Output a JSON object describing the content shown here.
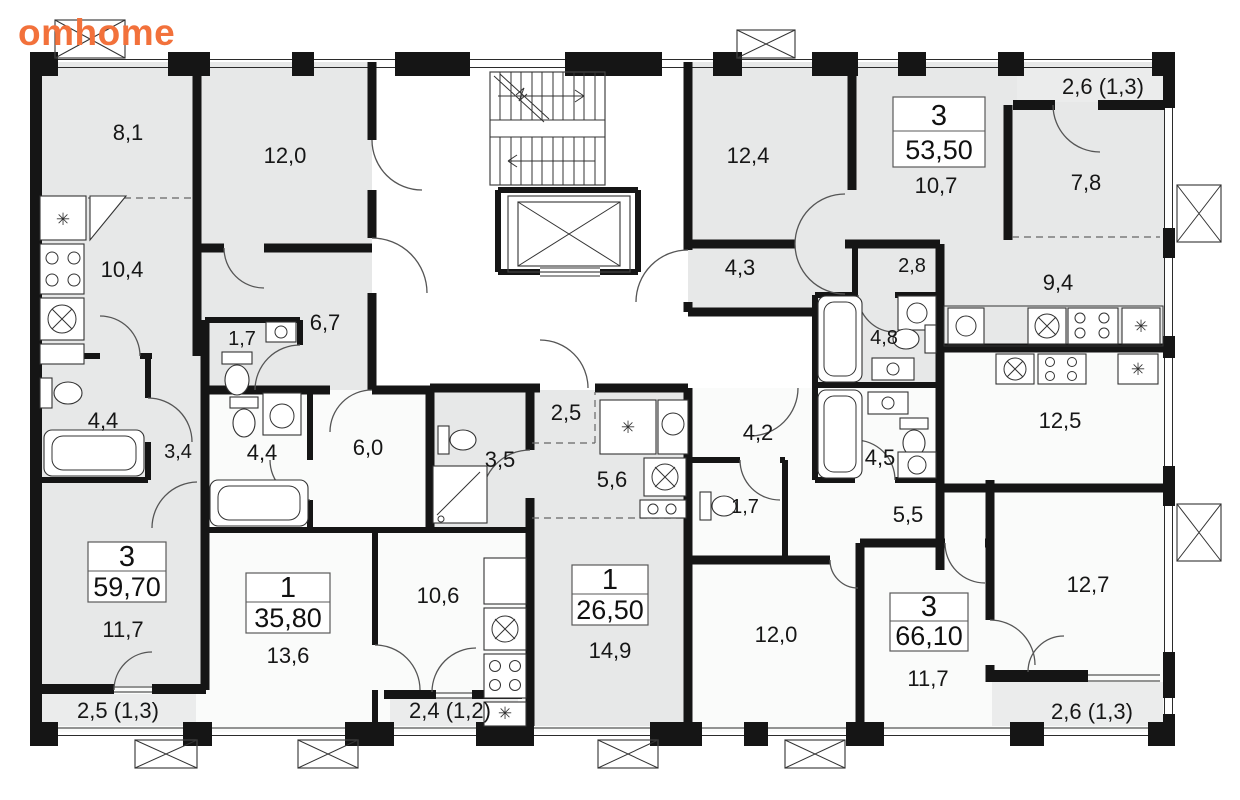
{
  "brand": {
    "logo_text": "omhome"
  },
  "colors": {
    "wall": "#151515",
    "room_shaded": "#e7e8e8",
    "room_plain": "#fafbfa",
    "balcony": "#ebecec",
    "logo": "#f2713b"
  },
  "apartments": [
    {
      "rooms_count": "3",
      "total_area": "53,50"
    },
    {
      "rooms_count": "3",
      "total_area": "59,70"
    },
    {
      "rooms_count": "1",
      "total_area": "35,80"
    },
    {
      "rooms_count": "1",
      "total_area": "26,50"
    },
    {
      "rooms_count": "3",
      "total_area": "66,10"
    }
  ],
  "rooms": {
    "tl_room": "8,1",
    "tl_room2": "12,0",
    "tl_kitchen": "10,4",
    "tl_hall": "6,7",
    "tl_wc": "1,7",
    "tl_bath": "4,4",
    "tl_hall2": "3,4",
    "tl_bedroom": "11,7",
    "tl_balcony": "2,5 (1,3)",
    "m1_bath": "4,4",
    "m1_hall": "6,0",
    "m1_living": "13,6",
    "m1_kitchen": "10,6",
    "m1_balcony": "2,4 (1,2)",
    "m2_shower": "3,5",
    "m2_hall1": "2,5",
    "m2_hall2": "5,6",
    "m2_living": "14,9",
    "tr_room1": "12,4",
    "tr_room2": "10,7",
    "tr_hall": "4,3",
    "tr_ward": "2,8",
    "tr_bath": "4,8",
    "tr_kitchen": "9,4",
    "tr_room3": "7,8",
    "tr_balcony": "2,6 (1,3)",
    "br_kitchen": "12,5",
    "br_hall1": "4,2",
    "br_bath": "4,5",
    "br_wc": "1,7",
    "br_hall2": "5,5",
    "br_room1": "12,7",
    "br_room2": "12,0",
    "br_room3": "11,7",
    "br_balcony": "2,6 (1,3)"
  }
}
